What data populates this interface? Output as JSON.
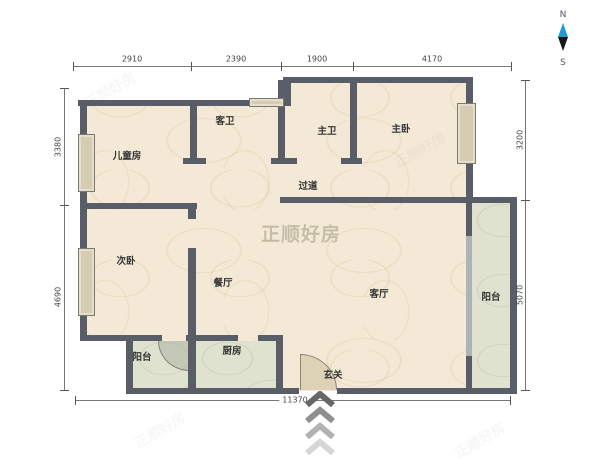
{
  "watermark": {
    "text": "正顺好房"
  },
  "compass": {
    "north": "N",
    "south": "S"
  },
  "rooms": [
    {
      "id": "children-room",
      "label": "儿童房"
    },
    {
      "id": "guest-bathroom",
      "label": "客卫"
    },
    {
      "id": "master-bathroom",
      "label": "主卫"
    },
    {
      "id": "master-bedroom",
      "label": "主卧"
    },
    {
      "id": "corridor",
      "label": "过道"
    },
    {
      "id": "second-bedroom",
      "label": "次卧"
    },
    {
      "id": "dining-room",
      "label": "餐厅"
    },
    {
      "id": "living-room",
      "label": "客厅"
    },
    {
      "id": "balcony-right",
      "label": "阳台"
    },
    {
      "id": "balcony-left",
      "label": "阳台"
    },
    {
      "id": "kitchen",
      "label": "厨房"
    },
    {
      "id": "entry",
      "label": "玄关"
    }
  ],
  "dimensions": {
    "top": [
      "2910",
      "2390",
      "1900",
      "4170"
    ],
    "bottom": [
      "11370"
    ],
    "left": [
      "3380",
      "4690"
    ],
    "right": [
      "3200",
      "5070"
    ]
  },
  "colors": {
    "wall": "#585d68",
    "floor": "#f4e9d6",
    "balcony_kitchen": "#dfe2cf",
    "needle_north": "#1e9bd4",
    "needle_south": "#161616",
    "watermark": "#bcb19a"
  }
}
